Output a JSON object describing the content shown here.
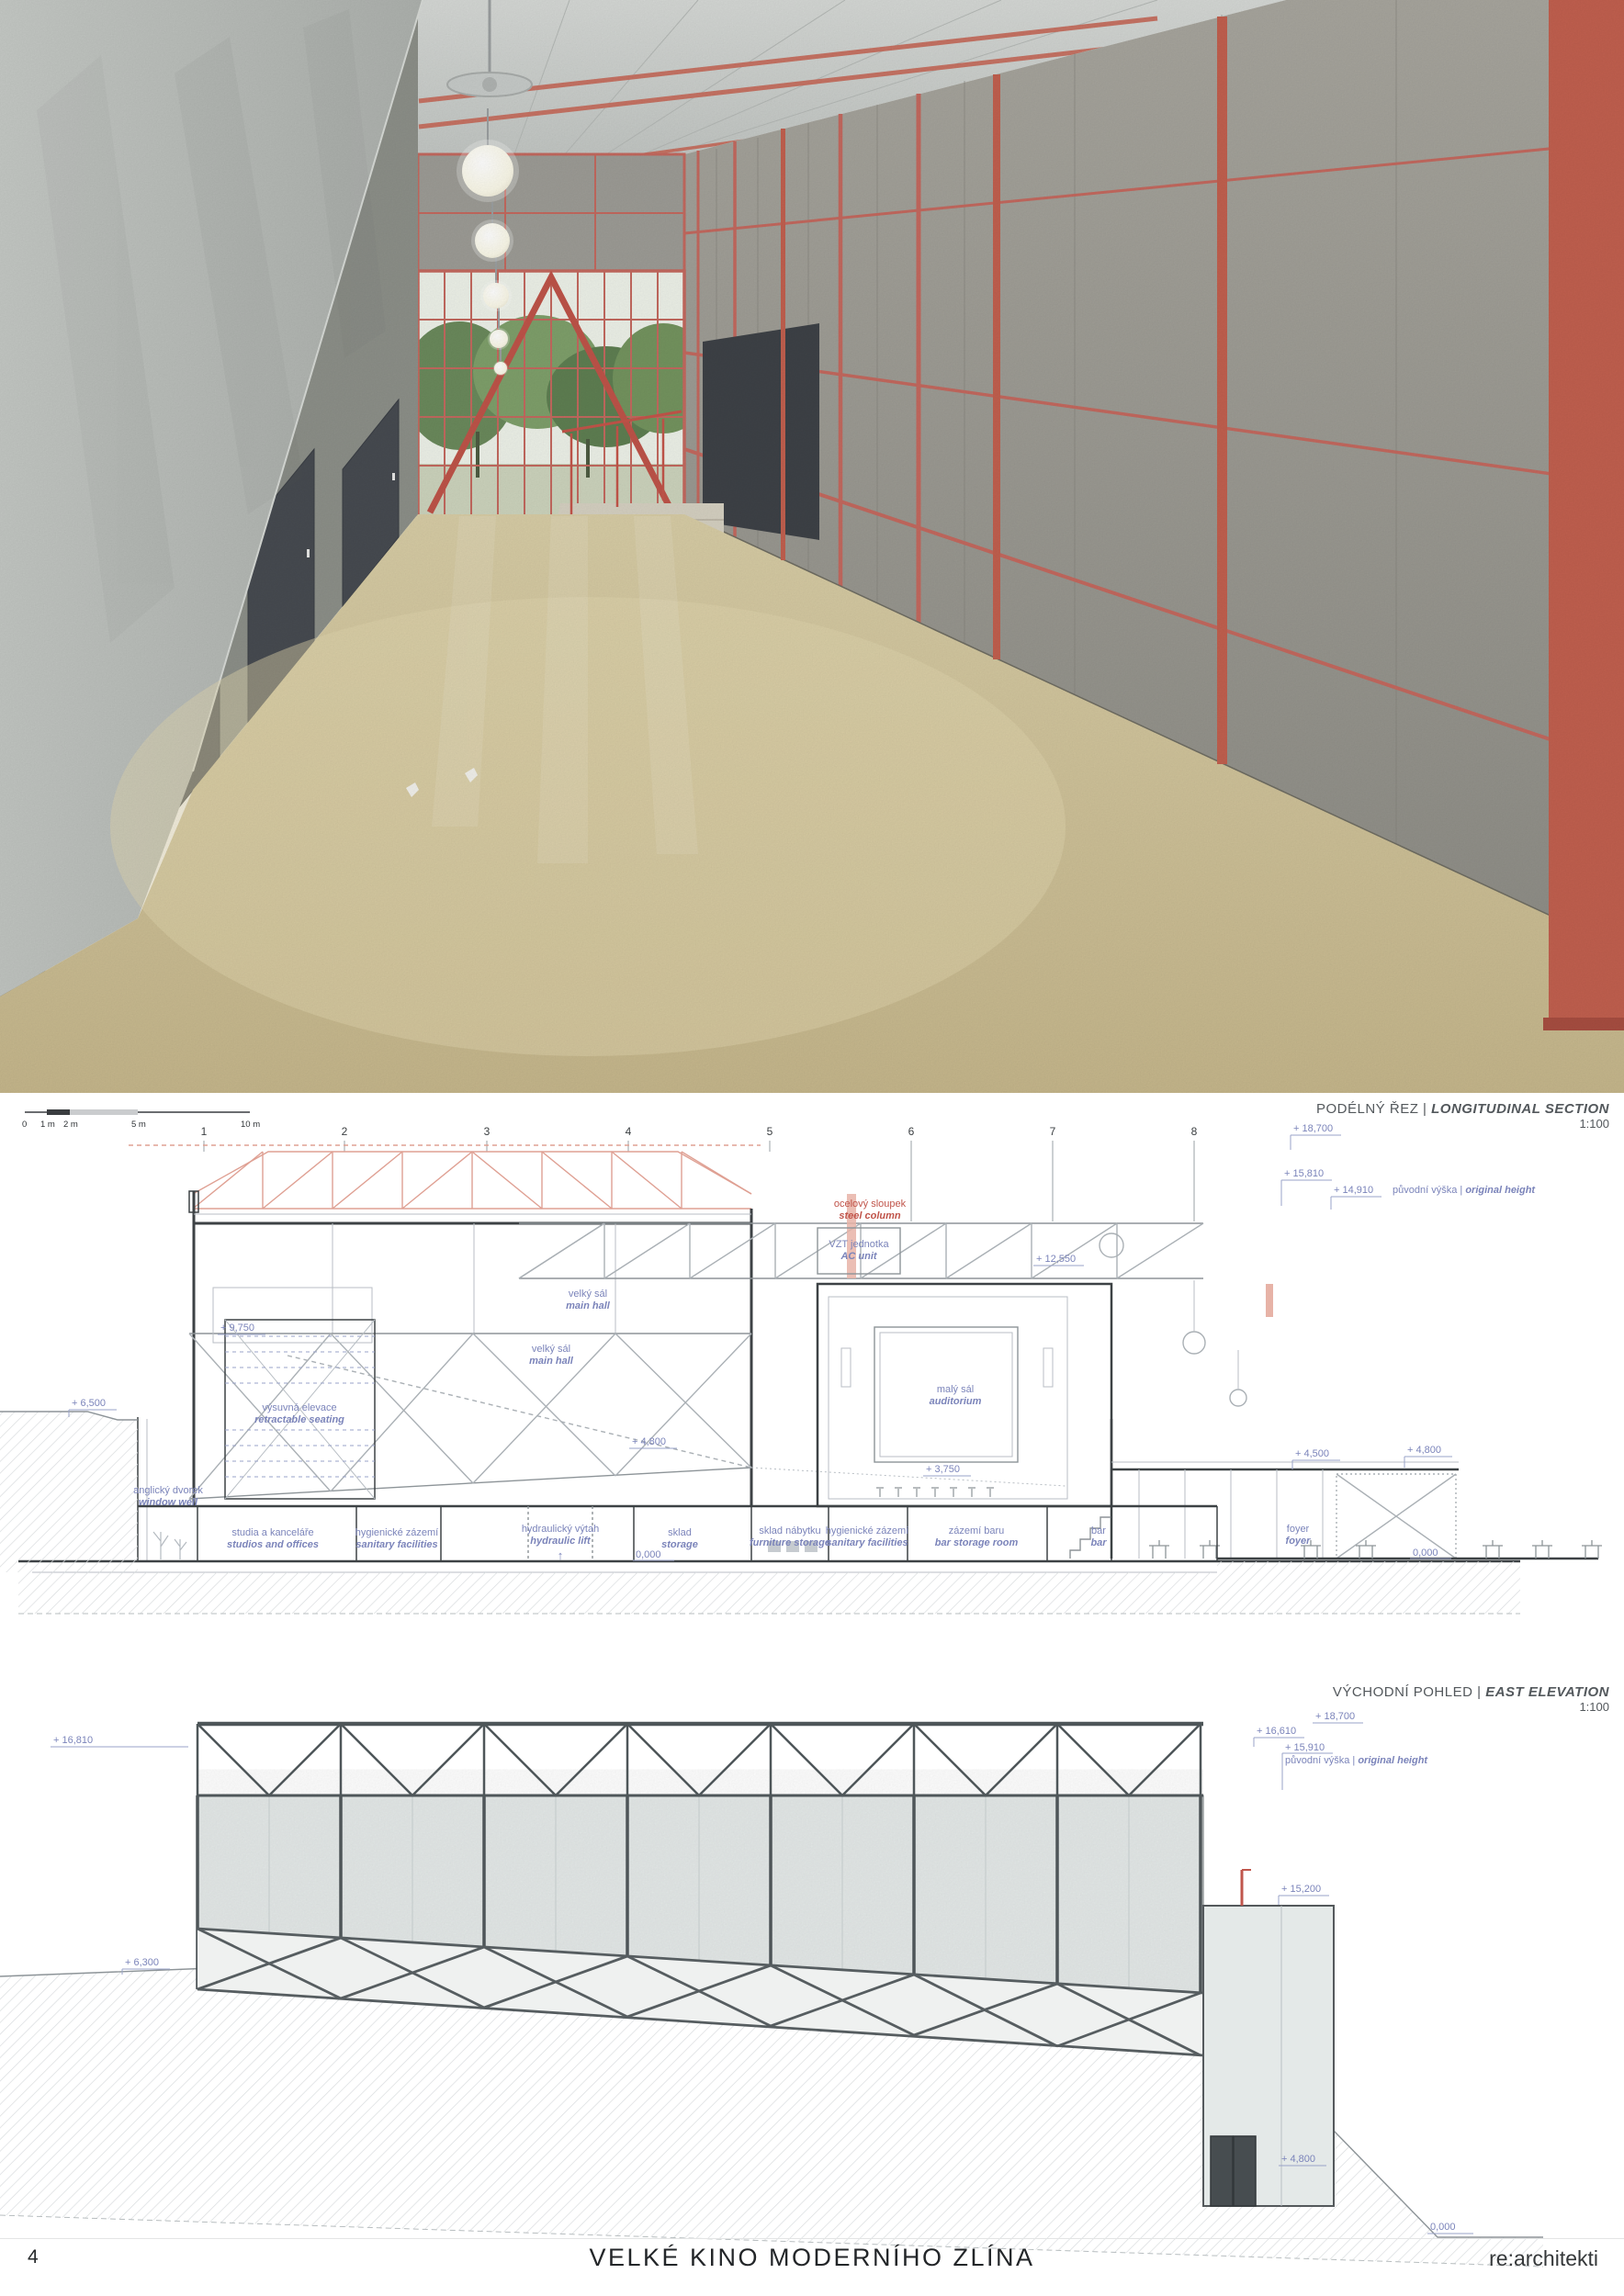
{
  "sep": "|",
  "colors": {
    "accent_red": "#c0544a",
    "truss_red": "#dfa093",
    "annotation_blue": "#7b84ba",
    "line_dark": "#3d4245",
    "floor_beige": "#d3c69f",
    "concrete_gray": "#bcc0bc"
  },
  "section": {
    "title_cz": "PODÉLNÝ ŘEZ",
    "title_en": "LONGITUDINAL SECTION",
    "scale": "1:100",
    "scalebar": {
      "t0": "0",
      "t1": "1 m",
      "t2": "2 m",
      "t3": "5 m",
      "t4": "10 m"
    },
    "grid": [
      "1",
      "2",
      "3",
      "4",
      "5",
      "6",
      "7",
      "8"
    ],
    "levels": [
      {
        "v": "+ 18,700"
      },
      {
        "v": "+ 15,810"
      },
      {
        "v": "+ 14,910",
        "note_cz": "původní výška",
        "note_en": "original height"
      },
      {
        "v": "+ 9,750"
      },
      {
        "v": "+ 6,500"
      },
      {
        "v": "+ 12,550"
      },
      {
        "v": "+ 4,800"
      },
      {
        "v": "+ 3,750"
      },
      {
        "v": "+ 4,500"
      },
      {
        "v": "+ 4,800"
      },
      {
        "v": "0,000"
      },
      {
        "v": "0,000"
      }
    ],
    "notes": {
      "steel_column_cz": "ocelový sloupek",
      "steel_column_en": "steel column",
      "ac_cz": "VZT jednotka",
      "ac_en": "AC unit"
    },
    "rooms": [
      {
        "cz": "velký sál",
        "en": "main hall"
      },
      {
        "cz": "velký sál",
        "en": "main hall"
      },
      {
        "cz": "malý sál",
        "en": "auditorium"
      },
      {
        "cz": "výsuvná elevace",
        "en": "retractable seating"
      },
      {
        "cz": "anglický dvorek",
        "en": "window well"
      },
      {
        "cz": "studia a kanceláře",
        "en": "studios and offices"
      },
      {
        "cz": "hygienické zázemí",
        "en": "sanitary facilities"
      },
      {
        "cz": "hydraulický výtah",
        "en": "hydraulic lift"
      },
      {
        "cz": "sklad",
        "en": "storage"
      },
      {
        "cz": "sklad nábytku",
        "en": "furniture storage"
      },
      {
        "cz": "hygienické zázemí",
        "en": "sanitary facilities"
      },
      {
        "cz": "zázemí baru",
        "en": "bar storage room"
      },
      {
        "cz": "bar",
        "en": "bar"
      },
      {
        "cz": "foyer",
        "en": "foyer"
      }
    ],
    "lift_arrow": "↑"
  },
  "elevation": {
    "title_cz": "VÝCHODNÍ POHLED",
    "title_en": "EAST ELEVATION",
    "scale": "1:100",
    "levels": [
      {
        "v": "+ 18,700"
      },
      {
        "v": "+ 16,610"
      },
      {
        "v": "+ 15,910",
        "note_cz": "původní výška",
        "note_en": "original height"
      },
      {
        "v": "+ 16,810"
      },
      {
        "v": "+ 15,200"
      },
      {
        "v": "+ 6,300"
      },
      {
        "v": "+ 4,800"
      },
      {
        "v": "0,000"
      }
    ]
  },
  "footer": {
    "page_number": "4",
    "title": "VELKÉ KINO MODERNÍHO ZLÍNA",
    "studio": "re:architekti"
  }
}
